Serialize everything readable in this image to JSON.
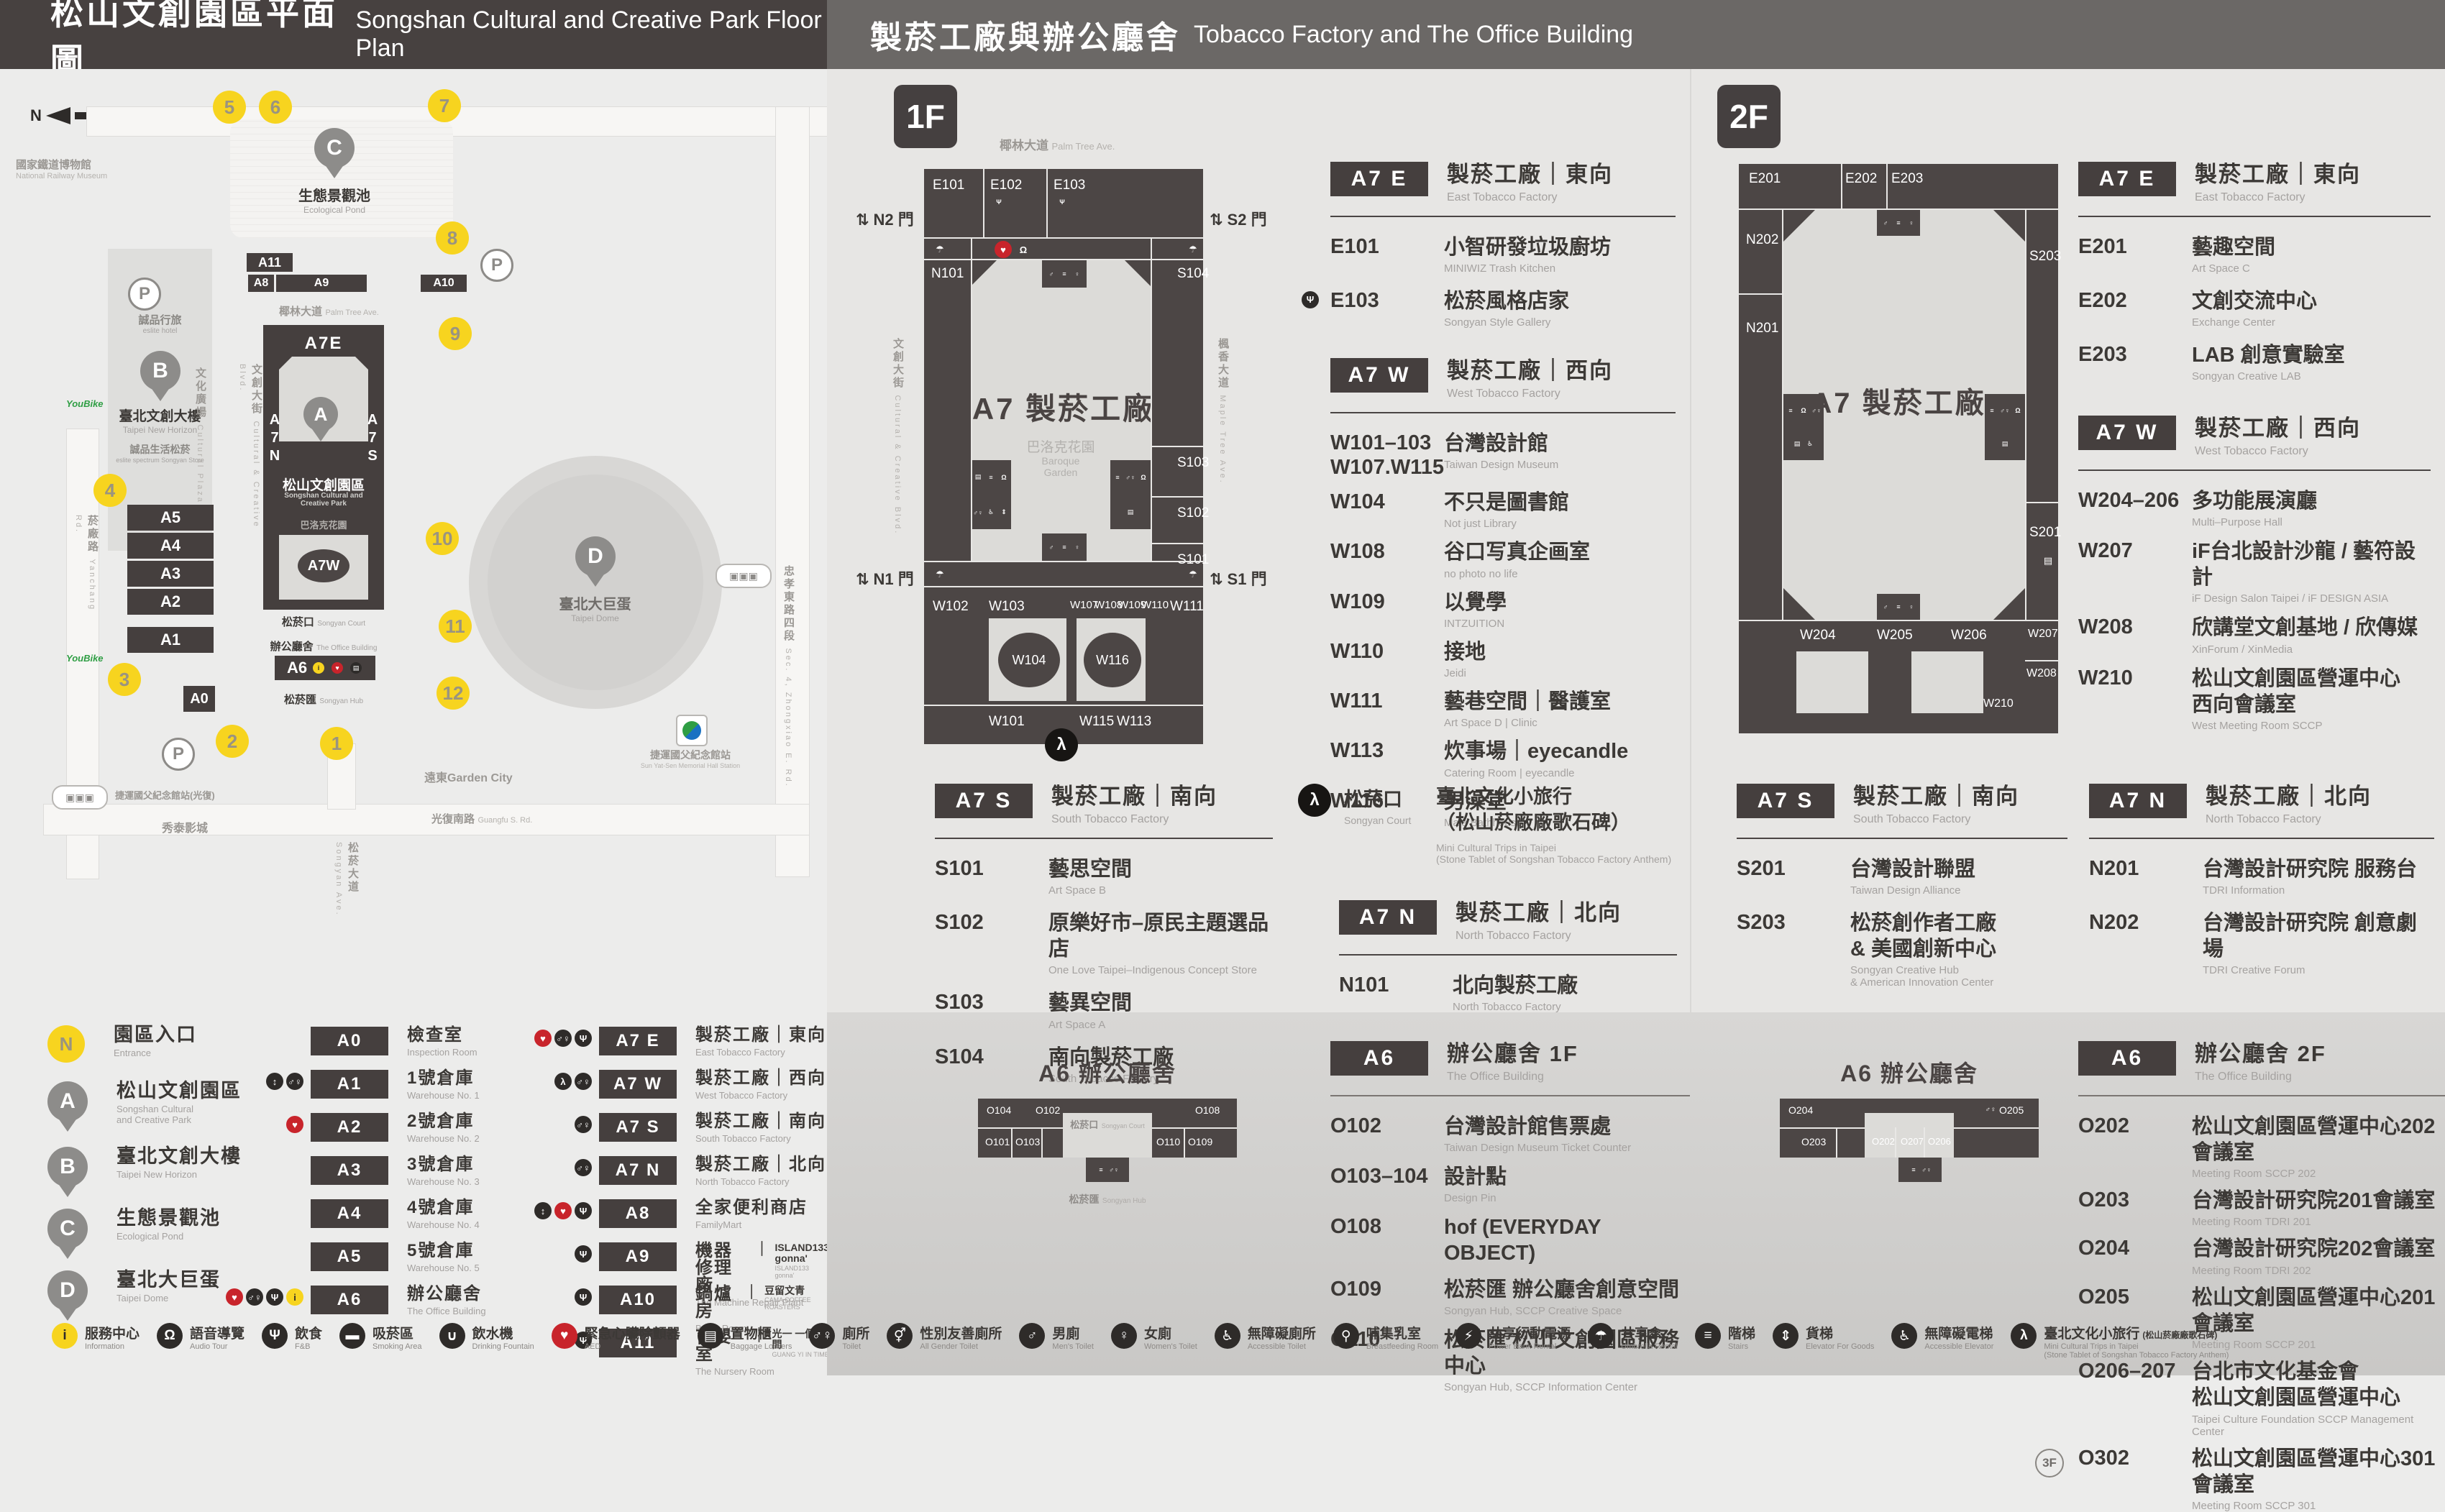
{
  "icon_glyphs": {
    "info": "i",
    "audio": "Ω",
    "food": "Ψ",
    "smoking": "▬",
    "water": "∪",
    "aed": "♥",
    "locker": "▤",
    "toilet": "♂♀",
    "all-gender": "⚥",
    "men": "♂",
    "women": "♀",
    "accessible": "♿",
    "breastfeeding": "⚲",
    "power": "⚡",
    "umbrella": "☂",
    "stairs": "≡",
    "goods-elevator": "⇕",
    "accessible-elevator": "♿",
    "elevator": "↕",
    "trips": "λ"
  },
  "header_left": {
    "zh": "松山文創園區平面圖",
    "en": "Songshan Cultural and Creative Park Floor Plan"
  },
  "header_right": {
    "zh": "製菸工廠與辦公廳舍",
    "en": "Tobacco Factory and The Office Building"
  },
  "map": {
    "north": "N",
    "entrances": [
      "1",
      "2",
      "3",
      "4",
      "5",
      "6",
      "7",
      "8",
      "9",
      "10",
      "11",
      "12"
    ],
    "pin_letters": {
      "a": "A",
      "b": "B",
      "c": "C",
      "d": "D"
    },
    "blocks": {
      "a0": "A0",
      "a1": "A1",
      "a2": "A2",
      "a3": "A3",
      "a4": "A4",
      "a5": "A5",
      "a6": "A6",
      "a7e": "A7E",
      "a7w": "A7W",
      "a7n": "A\n7\nN",
      "a7s": "A\n7\nS",
      "a8": "A8",
      "a9": "A9",
      "a10": "A10",
      "a11": "A11"
    },
    "labels": {
      "railway_museum": {
        "zh": "國家鐵道博物館",
        "en": "National Railway Museum"
      },
      "eslite_hotel": {
        "zh": "誠品行旅",
        "en": "eslite hotel"
      },
      "new_horizon": {
        "zh": "臺北文創大樓",
        "en": "Taipei New Horizon"
      },
      "eslite_spectrum": {
        "zh": "誠品生活松菸",
        "en": "eslite spectrum Songyan Store"
      },
      "cultural_plaza": {
        "zh": "文化廣場",
        "en": "Cultural Plaza"
      },
      "pond": {
        "zh": "生態景觀池",
        "en": "Ecological Pond"
      },
      "palm": {
        "zh": "椰林大道",
        "en": "Palm Tree Ave."
      },
      "ccblvd": {
        "zh": "文創大街",
        "en": "Cultural & Creative Blvd."
      },
      "maple": {
        "zh": "楓香大道",
        "en": "Maple Tree Ave."
      },
      "yanchang": {
        "zh": "菸廠路",
        "en": "Yanchang Rd."
      },
      "zhongxiao": {
        "zh": "忠孝東路四段",
        "en": "Sec. 4, Zhongxiao E. Rd."
      },
      "guangfu": {
        "zh": "光復南路",
        "en": "Guangfu S. Rd."
      },
      "park": {
        "zh": "松山文創園區",
        "en": "Songshan Cultural and\nCreative Park"
      },
      "baroque": {
        "zh": "巴洛克花園",
        "en": "Baroque Garden"
      },
      "court": {
        "zh": "松菸口",
        "en": "Songyan Court"
      },
      "office": {
        "zh": "辦公廳舍",
        "en": "The Office Building"
      },
      "hub": {
        "zh": "松菸匯",
        "en": "Songyan Hub"
      },
      "songyan_ave": {
        "zh": "松菸大道",
        "en": "Songyan Ave."
      },
      "dome": {
        "zh": "臺北大巨蛋",
        "en": "Taipei Dome"
      },
      "garden_city": {
        "zh": "遠東Garden City"
      },
      "showtimes": {
        "zh": "秀泰影城"
      },
      "mrt": {
        "zh": "捷運國父紀念館站",
        "en": "Sun Yat-Sen Memorial Hall Station"
      },
      "mrt_exit": {
        "zh": "捷運國父紀念館站(光復)"
      },
      "ubike": "YouBike"
    }
  },
  "f1": {
    "badge": "1F",
    "plan": {
      "title": "A7 製菸工廠",
      "garden_zh": "巴洛克花園",
      "garden_en": "Baroque\nGarden",
      "palm_zh": "椰林大道",
      "palm_en": "Palm Tree Ave.",
      "ccblvd_zh": "文創大街",
      "ccblvd_en": "Cultural & Creative Blvd.",
      "maple_zh": "楓香大道",
      "maple_en": "Maple Tree Ave.",
      "gates": {
        "n2": "N2 門",
        "s2": "S2 門",
        "n1": "N1 門",
        "s1": "S1 門"
      },
      "rooms": {
        "e101": "E101",
        "e102": "E102",
        "e103": "E103",
        "n101": "N101",
        "s101": "S101",
        "s102": "S102",
        "s103": "S103",
        "s104": "S104",
        "w101": "W101",
        "w102": "W102",
        "w103": "W103",
        "w104": "W104",
        "w107": "W107",
        "w108": "W108",
        "w109": "W109",
        "w110": "W110",
        "w111": "W111",
        "w113": "W113",
        "w115": "W115",
        "w116": "W116"
      }
    },
    "east": {
      "badge": "A7 E",
      "zh": "製菸工廠｜東向",
      "en": "East Tobacco Factory",
      "rows": [
        {
          "code": "E101",
          "zh": "小智研發垃圾廚坊",
          "en": "MINIWIZ Trash Kitchen"
        },
        {
          "pre_icons": [
            "food"
          ],
          "code": "E103",
          "zh": "松菸風格店家",
          "en": "Songyan Style Gallery"
        }
      ]
    },
    "west": {
      "badge": "A7 W",
      "zh": "製菸工廠｜西向",
      "en": "West Tobacco Factory",
      "rows": [
        {
          "code": "W101–103\nW107.W115",
          "zh": "台灣設計館",
          "en": "Taiwan Design Museum"
        },
        {
          "code": "W104",
          "zh": "不只是圖書館",
          "en": "Not just Library"
        },
        {
          "code": "W108",
          "zh": "谷口写真企画室",
          "en": "no photo no life"
        },
        {
          "code": "W109",
          "zh": "以覺學",
          "en": "INTZUITION"
        },
        {
          "code": "W110",
          "zh": "接地",
          "en": "Jeidi"
        },
        {
          "code": "W111",
          "zh": "藝巷空間｜醫護室",
          "en": "Art Space D | Clinic"
        },
        {
          "code": "W113",
          "zh": "炊事場｜eyecandle",
          "en": "Catering Room | eyecandle"
        },
        {
          "code": "W116",
          "zh": "男澡堂",
          "en": "Male Bathhouse"
        }
      ]
    },
    "south": {
      "badge": "A7 S",
      "zh": "製菸工廠｜南向",
      "en": "South Tobacco Factory",
      "rows": [
        {
          "code": "S101",
          "zh": "藝思空間",
          "en": "Art Space B"
        },
        {
          "code": "S102",
          "zh": "原樂好市–原民主題選品店",
          "en": "One Love Taipei–Indigenous Concept Store"
        },
        {
          "code": "S103",
          "zh": "藝異空間",
          "en": "Art Space A"
        },
        {
          "code": "S104",
          "zh": "南向製菸工廠",
          "en": "South Tobacco Factory"
        }
      ]
    },
    "north": {
      "badge": "A7 N",
      "zh": "製菸工廠｜北向",
      "en": "North Tobacco Factory",
      "rows": [
        {
          "code": "N101",
          "zh": "北向製菸工廠",
          "en": "North Tobacco Factory"
        }
      ]
    },
    "songyankou": {
      "zh": "松菸口",
      "en": "Songyan Court",
      "line1": "臺北文化小旅行",
      "line2": "（松山菸廠廠歌石碑）",
      "en1": "Mini Cultural Trips in Taipei",
      "en2": "(Stone Tablet of Songshan Tobacco Factory Anthem)"
    }
  },
  "f2": {
    "badge": "2F",
    "plan": {
      "title": "A7 製菸工廠",
      "rooms": {
        "e201": "E201",
        "e202": "E202",
        "e203": "E203",
        "n201": "N201",
        "n202": "N202",
        "s201": "S201",
        "s203": "S203",
        "w204": "W204",
        "w205": "W205",
        "w206": "W206",
        "w207": "W207",
        "w208": "W208",
        "w210": "W210"
      }
    },
    "east": {
      "badge": "A7 E",
      "zh": "製菸工廠｜東向",
      "en": "East Tobacco Factory",
      "rows": [
        {
          "code": "E201",
          "zh": "藝趣空間",
          "en": "Art Space C"
        },
        {
          "code": "E202",
          "zh": "文創交流中心",
          "en": "Exchange Center"
        },
        {
          "code": "E203",
          "zh": "LAB 創意實驗室",
          "en": "Songyan Creative LAB"
        }
      ]
    },
    "west": {
      "badge": "A7 W",
      "zh": "製菸工廠｜西向",
      "en": "West Tobacco Factory",
      "rows": [
        {
          "code": "W204–206",
          "zh": "多功能展演廳",
          "en": "Multi–Purpose Hall"
        },
        {
          "code": "W207",
          "zh": "iF台北設計沙龍 / 藝符設計",
          "en": "iF Design Salon Taipei / iF DESIGN ASIA"
        },
        {
          "code": "W208",
          "zh": "欣講堂文創基地 / 欣傳媒",
          "en": "XinForum / XinMedia"
        },
        {
          "code": "W210",
          "zh": "松山文創園區營運中心\n西向會議室",
          "en": "West Meeting Room SCCP"
        }
      ]
    },
    "south": {
      "badge": "A7 S",
      "zh": "製菸工廠｜南向",
      "en": "South Tobacco Factory",
      "rows": [
        {
          "code": "S201",
          "zh": "台灣設計聯盟",
          "en": "Taiwan Design Alliance"
        },
        {
          "code": "S203",
          "zh": "松菸創作者工廠\n& 美國創新中心",
          "en": "Songyan Creative Hub\n& American Innovation Center"
        }
      ]
    },
    "north": {
      "badge": "A7 N",
      "zh": "製菸工廠｜北向",
      "en": "North Tobacco Factory",
      "rows": [
        {
          "code": "N201",
          "zh": "台灣設計研究院 服務台",
          "en": "TDRI Information"
        },
        {
          "code": "N202",
          "zh": "台灣設計研究院 創意劇場",
          "en": "TDRI Creative Forum"
        }
      ]
    }
  },
  "a6_1f": {
    "badge": "A6",
    "zh": "辦公廳舍 1F",
    "en": "The Office Building",
    "plan": {
      "title": "A6 辦公廳舍",
      "court_zh": "松菸口",
      "court_en": "Songyan Court",
      "hub_zh": "松菸匯",
      "hub_en": "Songyan Hub",
      "cells": [
        "O104",
        "O101",
        "O103",
        "O102",
        "O110",
        "O109",
        "O108"
      ]
    },
    "rows": [
      {
        "code": "O102",
        "zh": "台灣設計館售票處",
        "en": "Taiwan Design Museum Ticket Counter"
      },
      {
        "code": "O103–104",
        "zh": "設計點",
        "en": "Design Pin"
      },
      {
        "code": "O108",
        "zh": "hof (EVERYDAY OBJECT)"
      },
      {
        "code": "O109",
        "zh": "松菸匯 辦公廳舍創意空間",
        "en": "Songyan Hub, SCCP Creative Space"
      },
      {
        "code": "O110",
        "zh": "松菸匯 松山文創園區服務中心",
        "en": "Songyan Hub, SCCP Information Center"
      }
    ]
  },
  "a6_2f": {
    "badge": "A6",
    "zh": "辦公廳舍 2F",
    "en": "The Office Building",
    "plan": {
      "title": "A6 辦公廳舍",
      "cells": [
        "O204",
        "O203",
        "O202",
        "O207",
        "O206",
        "O205"
      ]
    },
    "rows": [
      {
        "code": "O202",
        "zh": "松山文創園區營運中心202會議室",
        "en": "Meeting Room SCCP 202"
      },
      {
        "code": "O203",
        "zh": "台灣設計研究院201會議室",
        "en": "Meeting Room TDRI 201"
      },
      {
        "code": "O204",
        "zh": "台灣設計研究院202會議室",
        "en": "Meeting Room TDRI 202"
      },
      {
        "code": "O205",
        "zh": "松山文創園區營運中心201會議室",
        "en": "Meeting Room SCCP 201"
      },
      {
        "code": "O206–207",
        "zh": "台北市文化基金會\n松山文創園區營運中心",
        "en": "Taipei Culture Foundation SCCP Management Center"
      },
      {
        "prefix": "3F",
        "code": "O302",
        "zh": "松山文創園區營運中心301會議室",
        "en": "Meeting Room SCCP 301"
      }
    ]
  },
  "legend": {
    "places": [
      {
        "marker": "N",
        "kind": "circle",
        "zh": "園區入口",
        "en": "Entrance"
      },
      {
        "marker": "A",
        "kind": "pin",
        "zh": "松山文創園區",
        "en": "Songshan Cultural\nand Creative Park"
      },
      {
        "marker": "B",
        "kind": "pin",
        "zh": "臺北文創大樓",
        "en": "Taipei New Horizon"
      },
      {
        "marker": "C",
        "kind": "pin",
        "zh": "生態景觀池",
        "en": "Ecological Pond"
      },
      {
        "marker": "D",
        "kind": "pin",
        "zh": "臺北大巨蛋",
        "en": "Taipei Dome"
      }
    ],
    "col1": [
      {
        "code": "A0",
        "zh": "檢查室",
        "en": "Inspection Room"
      },
      {
        "icons": [
          "elevator",
          "toilet"
        ],
        "code": "A1",
        "zh": "1號倉庫",
        "en": "Warehouse No. 1"
      },
      {
        "icons": [
          "aed"
        ],
        "code": "A2",
        "zh": "2號倉庫",
        "en": "Warehouse No. 2"
      },
      {
        "code": "A3",
        "zh": "3號倉庫",
        "en": "Warehouse No. 3"
      },
      {
        "code": "A4",
        "zh": "4號倉庫",
        "en": "Warehouse No. 4"
      },
      {
        "code": "A5",
        "zh": "5號倉庫",
        "en": "Warehouse No. 5"
      },
      {
        "icons": [
          "aed",
          "toilet",
          "food",
          "info"
        ],
        "code": "A6",
        "zh": "辦公廳舍",
        "en": "The Office Building"
      }
    ],
    "col2": [
      {
        "icons": [
          "aed",
          "toilet",
          "food"
        ],
        "code": "A7 E",
        "zh": "製菸工廠｜東向",
        "en": "East Tobacco Factory"
      },
      {
        "icons": [
          "trips",
          "toilet"
        ],
        "code": "A7 W",
        "zh": "製菸工廠｜西向",
        "en": "West Tobacco Factory"
      },
      {
        "icons": [
          "toilet"
        ],
        "code": "A7 S",
        "zh": "製菸工廠｜南向",
        "en": "South Tobacco Factory"
      },
      {
        "icons": [
          "toilet"
        ],
        "code": "A7 N",
        "zh": "製菸工廠｜北向",
        "en": "North Tobacco Factory"
      },
      {
        "icons": [
          "elevator",
          "aed",
          "food"
        ],
        "code": "A8",
        "zh": "全家便利商店",
        "en": "FamilyMart"
      },
      {
        "icons": [
          "food"
        ],
        "code": "A9",
        "zh": "機器修理廠",
        "brand_zh": "ISLAND133 gonna'",
        "brand_en": "ISLAND133 gonna'",
        "en": "The Machine Repair Plant"
      },
      {
        "icons": [
          "food"
        ],
        "code": "A10",
        "zh": "鍋爐房",
        "brand_zh": "豆留文青",
        "brand_en": "CAMA COFFEE ROASTERS",
        "en": "Boiler Room"
      },
      {
        "icons": [
          "food"
        ],
        "code": "A11",
        "zh": "育嬰室",
        "brand_zh": "光一 一個時間",
        "brand_en": "GUANG YI IN TIME",
        "en": "The Nursery Room"
      }
    ]
  },
  "facilities": [
    {
      "cls": "c-yellow",
      "icons": [
        "info"
      ],
      "zh": "服務中心",
      "en": "Information"
    },
    {
      "icons": [
        "audio"
      ],
      "zh": "語音導覽",
      "en": "Audio Tour"
    },
    {
      "icons": [
        "food"
      ],
      "zh": "飲食",
      "en": "F&B"
    },
    {
      "icons": [
        "smoking"
      ],
      "zh": "吸菸區",
      "en": "Smoking Area"
    },
    {
      "icons": [
        "water"
      ],
      "zh": "飲水機",
      "en": "Drinking Fountain"
    },
    {
      "cls": "c-red",
      "icons": [
        "aed"
      ],
      "zh": "緊急心臟除顫器",
      "en": "AED"
    },
    {
      "icons": [
        "locker"
      ],
      "zh": "置物櫃",
      "en": "Baggage Lockers"
    },
    {
      "icons": [
        "toilet"
      ],
      "zh": "廁所",
      "en": "Toilet"
    },
    {
      "icons": [
        "all-gender"
      ],
      "zh": "性別友善廁所",
      "en": "All Gender Toilet"
    },
    {
      "icons": [
        "men"
      ],
      "zh": "男廁",
      "en": "Men's Toilet"
    },
    {
      "icons": [
        "women"
      ],
      "zh": "女廁",
      "en": "Women's Toilet"
    },
    {
      "icons": [
        "accessible"
      ],
      "zh": "無障礙廁所",
      "en": "Accessible Toilet"
    },
    {
      "icons": [
        "breastfeeding"
      ],
      "zh": "哺集乳室",
      "en": "Breastfeeding Room"
    },
    {
      "icons": [
        "power"
      ],
      "zh": "共享行動電源",
      "en": "Power Bank Rental"
    },
    {
      "icons": [
        "umbrella"
      ],
      "zh": "共享傘",
      "en": "Umbrella Rental"
    },
    {
      "icons": [
        "stairs"
      ],
      "zh": "階梯",
      "en": "Stairs"
    },
    {
      "icons": [
        "goods-elevator"
      ],
      "zh": "貨梯",
      "en": "Elevator For Goods"
    },
    {
      "icons": [
        "accessible-elevator"
      ],
      "zh": "無障礙電梯",
      "en": "Accessible Elevator"
    },
    {
      "icons": [
        "trips"
      ],
      "zh": "臺北文化小旅行",
      "zh2": "(松山菸廠廠歌石碑)",
      "en": "Mini Cultural Trips in Taipei",
      "en2": "(Stone Tablet of Songshan Tobacco Factory Anthem)"
    }
  ]
}
